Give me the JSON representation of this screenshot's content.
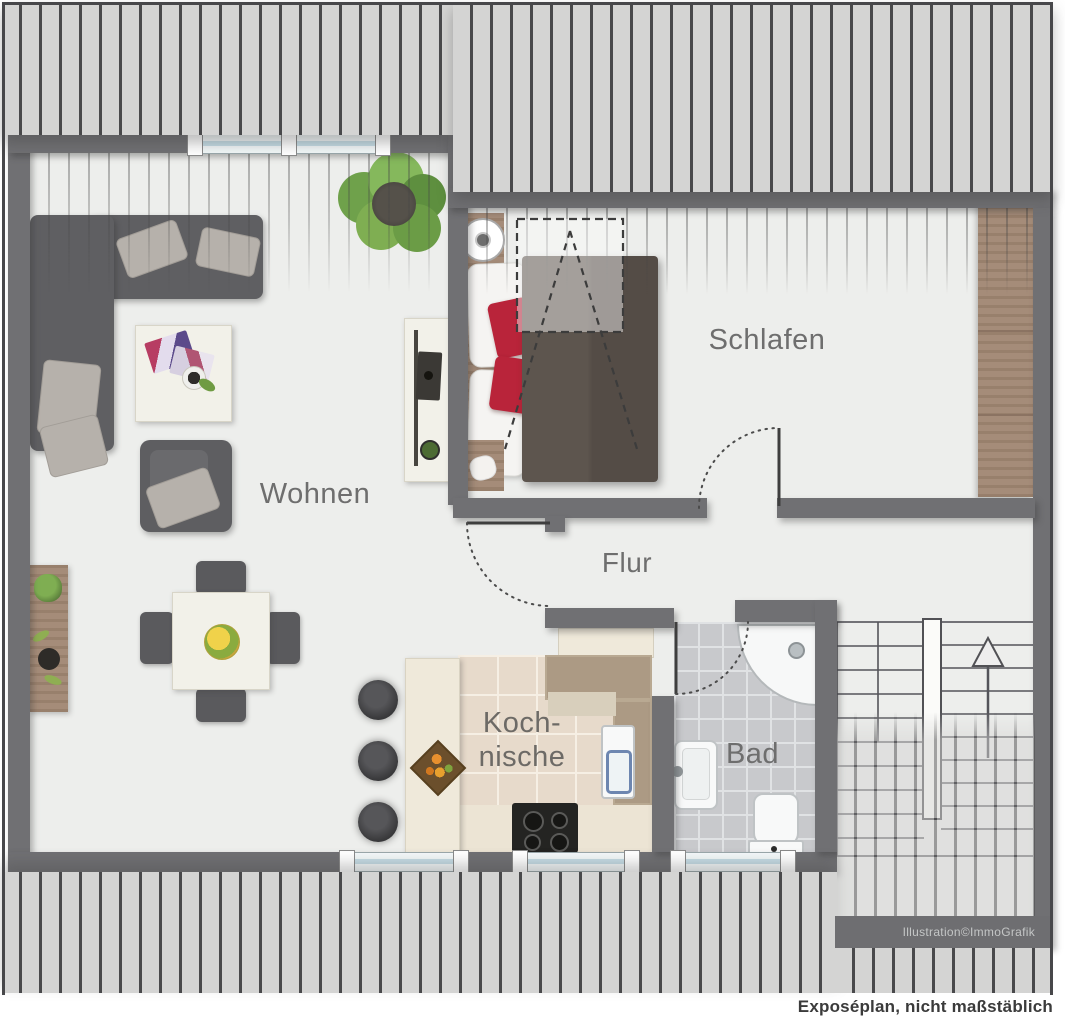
{
  "plan": {
    "caption": "Exposéplan, nicht maßstäblich",
    "watermark": "Illustration©ImmoGrafik",
    "rooms": {
      "wohnen": {
        "label": "Wohnen"
      },
      "schlafen": {
        "label": "Schlafen"
      },
      "flur": {
        "label": "Flur"
      },
      "kochnische": {
        "line1": "Koch-",
        "line2": "nische"
      },
      "bad": {
        "label": "Bad"
      }
    },
    "colors": {
      "wall": "#707073",
      "floor": "#edeeec",
      "hatch_background": "#d4d4d3",
      "hatch_line": "#49494b",
      "wood": "#a58c79",
      "accent_red": "#bb2433",
      "kitchen_tile": "#e7dacb",
      "bath_tile": "#c8c9cc",
      "window_glass": "#c6dde6",
      "label_text": "#6e6e6e",
      "caption_text": "#3b3b3b"
    },
    "furniture": {
      "wohnen": [
        "corner-sofa",
        "coffee-table",
        "armchair",
        "tv-sideboard",
        "dining-table",
        "dining-chairs",
        "fruit-bowl",
        "plant",
        "wall-planter",
        "bar-stools"
      ],
      "schlafen": [
        "double-bed",
        "nightstand-lamp",
        "wardrobe",
        "skylight"
      ],
      "kochnische": [
        "kitchen-counter",
        "sink",
        "stove",
        "bar-counter",
        "fruit-basket",
        "cupboard"
      ],
      "bad": [
        "corner-shower",
        "washbasin",
        "toilet"
      ],
      "treppenhaus": [
        "staircase",
        "up-arrow"
      ]
    }
  }
}
